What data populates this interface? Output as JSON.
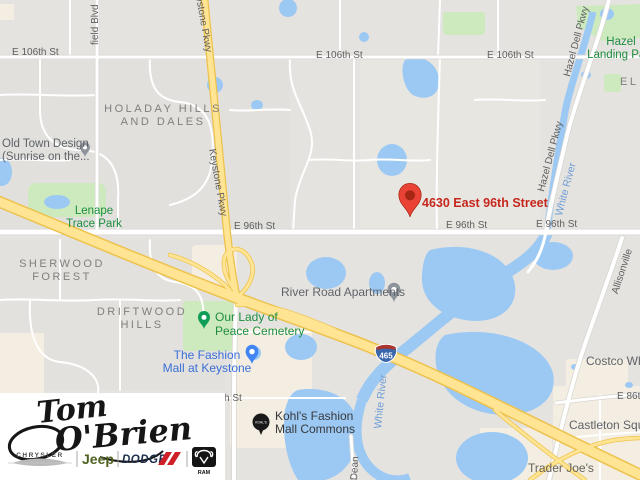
{
  "map": {
    "address_marker": {
      "label": "4630 East 96th Street"
    },
    "shield": {
      "number": "465"
    },
    "streets": {
      "e106_left": "E 106th St",
      "e106_mid": "E 106th St",
      "e106_right": "E 106th St",
      "e96_left": "E 96th St",
      "e96_mid": "E 96th St",
      "e96_right": "E 96th St",
      "e86": "E 86th St",
      "partial_h_st": "h St",
      "keystone_partial": "ystone Pkwy",
      "keystone": "Keystone Pkwy",
      "hazel_dell_1": "Hazel Dell Pkwy",
      "hazel_dell_2": "Hazel Dell Pkwy",
      "westfield_partial": "field Blvd",
      "allisonville": "Allisonville",
      "dean": "Dean"
    },
    "water": {
      "white_river_1": "White River",
      "white_river_2": "White River"
    },
    "neighborhoods": {
      "holaday_1": "HOLADAY HILLS",
      "holaday_2": "AND DALES",
      "sherwood_1": "SHERWOOD",
      "sherwood_2": "FOREST",
      "driftwood_1": "DRIFTWOOD",
      "driftwood_2": "HILLS",
      "partial_el": "EL"
    },
    "parks": {
      "lenape_1": "Lenape",
      "lenape_2": "Trace Park",
      "hazel_landing_1": "Hazel",
      "hazel_landing_2": "Landing Park",
      "cemetery_1": "Our Lady of",
      "cemetery_2": "Peace Cemetery"
    },
    "pois": {
      "old_town_1": "Old Town Design",
      "old_town_2": "(Sunrise on the...",
      "river_road_apartments": "River Road Apartments",
      "fashion_mall_1": "The Fashion",
      "fashion_mall_2": "Mall at Keystone",
      "kohls_1": "Kohl's Fashion",
      "kohls_2": "Mall Commons",
      "kohls_badge": "KOHL'S",
      "costco": "Costco Wholesale",
      "castleton": "Castleton Square",
      "trader_joes": "Trader Joe's"
    }
  },
  "logo": {
    "name_top": "Tom",
    "name_bottom": "O'Brien",
    "chrysler": "CHRYSLER",
    "jeep": "Jeep",
    "dodge": "DODGE",
    "ram": "RAM"
  },
  "colors": {
    "water": "#9cc9f3",
    "park": "#cdeabe",
    "highway": "#ffe494",
    "marker_red": "#ea4335",
    "address_text": "#c5271d",
    "poi_blue": "#3a6fd8",
    "poi_green": "#1e8e3e",
    "kohls_black": "#1a1a1a"
  }
}
